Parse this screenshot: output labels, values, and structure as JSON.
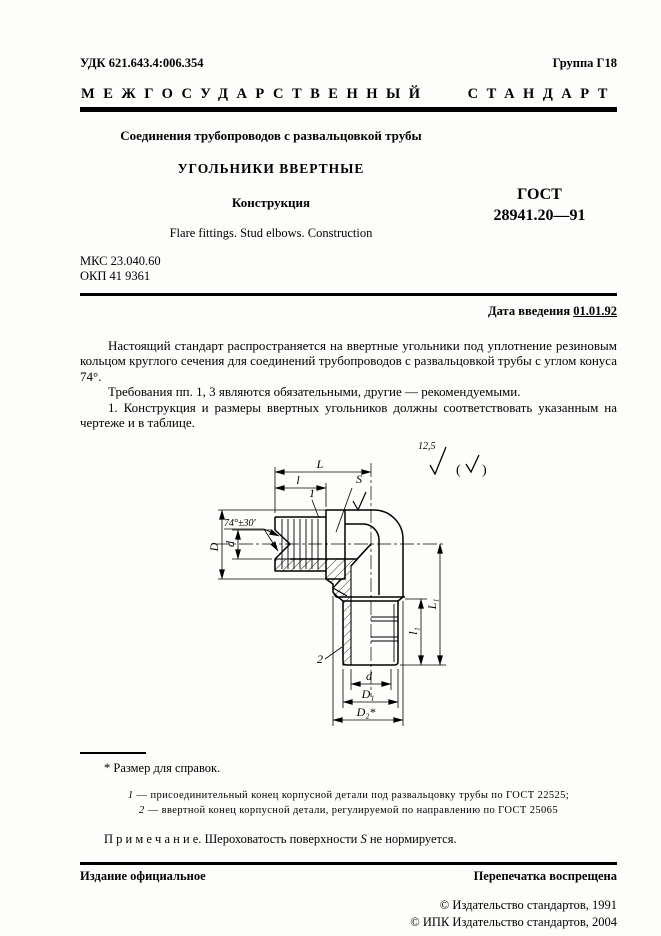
{
  "header": {
    "udc": "УДК 621.643.4:006.354",
    "group": "Группа Г18",
    "standard_type": "МЕЖГОСУДАРСТВЕННЫЙ СТАНДАРТ"
  },
  "title": {
    "subject": "Соединения трубопроводов с развальцовкой трубы",
    "main": "УГОЛЬНИКИ ВВЕРТНЫЕ",
    "subtitle": "Конструкция",
    "gost_label": "ГОСТ",
    "gost_number": "28941.20—91",
    "english": "Flare fittings. Stud elbows. Construction"
  },
  "codes": {
    "mks": "МКС 23.040.60",
    "okp": "ОКП 41 9361"
  },
  "date": {
    "label": "Дата введения",
    "value": "01.01.92"
  },
  "body": {
    "p1": "Настоящий стандарт распространяется на ввертные угольники под уплотнение резиновым кольцом круглого сечения для соединений трубопроводов с развальцовкой трубы с углом конуса 74°.",
    "p2": "Требования пп. 1, 3 являются обязательными, другие — рекомендуемыми.",
    "p3": "1. Конструкция и размеры ввертных угольников должны соответствовать указанным на чертеже и в таблице."
  },
  "drawing": {
    "roughness_value": "12,5",
    "paren_open": "(",
    "paren_close": ")",
    "labels": {
      "L": "L",
      "l": "l",
      "S": "S",
      "ref1": "1",
      "angle": "74°±30′",
      "D": "D",
      "d_left": "d",
      "L1": "L₁",
      "l1": "l₁",
      "d_bottom": "d",
      "D1": "D₁",
      "D2": "D₂*",
      "ref2": "2"
    }
  },
  "footnotes": {
    "ref_note": "* Размер для справок.",
    "item1_num": "1",
    "item1_text": "— присоединительный конец корпусной детали под развальцовку трубы по ГОСТ 22525;",
    "item2_num": "2",
    "item2_text": "— ввертной конец корпусной детали, регулируемой по направлению по ГОСТ 25065",
    "note_label": "П р и м е ч а н и е.",
    "note_pre": "Шероховатость поверхности",
    "note_var": "S",
    "note_post": "не нормируется."
  },
  "footer": {
    "edition": "Издание официальное",
    "reprint": "Перепечатка воспрещена",
    "copyright1": "© Издательство стандартов, 1991",
    "copyright2": "© ИПК Издательство стандартов, 2004"
  }
}
